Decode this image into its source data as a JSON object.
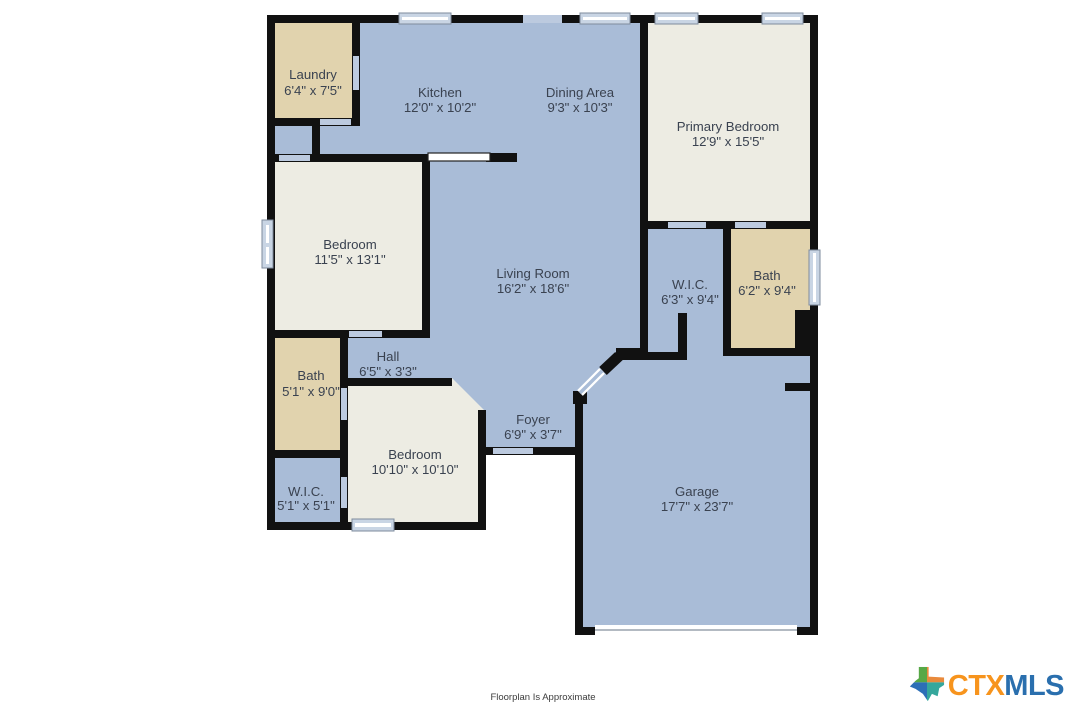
{
  "rooms": {
    "laundry": {
      "name": "Laundry",
      "dims": "6'4\" x 7'5\""
    },
    "kitchen": {
      "name": "Kitchen",
      "dims": "12'0\" x 10'2\""
    },
    "dining": {
      "name": "Dining Area",
      "dims": "9'3\" x 10'3\""
    },
    "primary": {
      "name": "Primary Bedroom",
      "dims": "12'9\" x 15'5\""
    },
    "bedroom1": {
      "name": "Bedroom",
      "dims": "11'5\" x 13'1\""
    },
    "living": {
      "name": "Living Room",
      "dims": "16'2\" x 18'6\""
    },
    "wic2": {
      "name": "W.I.C.",
      "dims": "6'3\" x 9'4\""
    },
    "bath2": {
      "name": "Bath",
      "dims": "6'2\" x 9'4\""
    },
    "bath1": {
      "name": "Bath",
      "dims": "5'1\" x 9'0\""
    },
    "hall": {
      "name": "Hall",
      "dims": "6'5\" x 3'3\""
    },
    "bedroom2": {
      "name": "Bedroom",
      "dims": "10'10\" x 10'10\""
    },
    "foyer": {
      "name": "Foyer",
      "dims": "6'9\" x 3'7\""
    },
    "wic1": {
      "name": "W.I.C.",
      "dims": "5'1\" x 5'1\""
    },
    "garage": {
      "name": "Garage",
      "dims": "17'7\" x 23'7\""
    }
  },
  "footer": {
    "disclaimer": "Floorplan Is Approximate"
  },
  "logo": {
    "ctx": "CTX",
    "mls": "MLS",
    "icon": "texas-state-icon"
  },
  "colors": {
    "room_blue": "#a9bcd7",
    "room_cream": "#edece3",
    "room_tan": "#e1d3ae",
    "wall": "#111111",
    "window_fill": "#c9d5e4",
    "door_fill": "#bccadf",
    "label_text": "#3a4250",
    "logo_orange": "#f7941d",
    "logo_blue": "#2a6fae",
    "logo_green": "#57a846",
    "logo_teal": "#35a79c"
  }
}
